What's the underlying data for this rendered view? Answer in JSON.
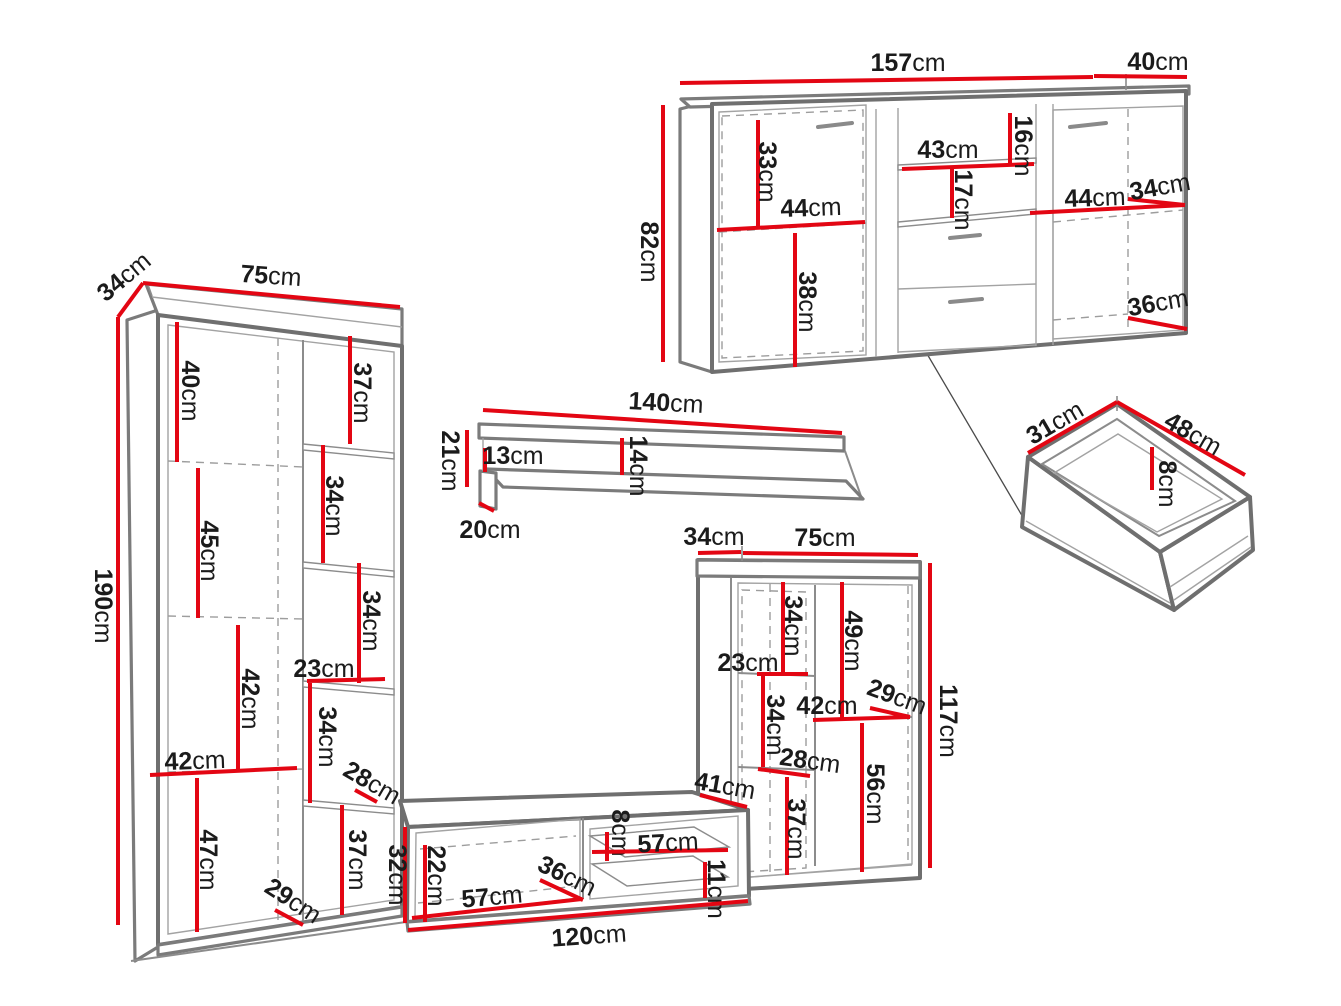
{
  "meta": {
    "title": "Wall unit furniture dimension diagram",
    "unit": "cm",
    "canvas": {
      "width": 1341,
      "height": 1006
    }
  },
  "colors": {
    "dimension_line": "#e30613",
    "outline": "#7b7b7b",
    "outline_light": "#a3a3a3",
    "label_text": "#1b1b1b",
    "background": "#ffffff"
  },
  "pieces": [
    {
      "id": "bookcase",
      "label": "tall bookcase",
      "width": "75cm",
      "depth": "34cm",
      "height": "190cm"
    },
    {
      "id": "sideboard",
      "label": "sideboard",
      "width": "157cm",
      "depth": "40cm",
      "height": "82cm"
    },
    {
      "id": "wall-shelf",
      "label": "wall shelf",
      "width": "140cm",
      "depth": "20cm",
      "height": "21cm"
    },
    {
      "id": "cabinet",
      "label": "display cabinet",
      "width": "75cm",
      "depth": "34cm",
      "height": "117cm"
    },
    {
      "id": "tv-stand",
      "label": "tv stand",
      "width": "120cm",
      "depth": "41cm",
      "height": "32cm"
    },
    {
      "id": "drawer",
      "label": "drawer box",
      "width": "48cm",
      "depth": "31cm",
      "height": "8cm"
    }
  ],
  "dimensions": [
    {
      "id": "bookcase-depth",
      "piece": "bookcase",
      "value": "34",
      "unit": "cm",
      "x": 124,
      "y": 277,
      "rot": -40,
      "line": [
        118,
        317,
        143,
        283
      ]
    },
    {
      "id": "bookcase-width",
      "piece": "bookcase",
      "value": "75",
      "unit": "cm",
      "x": 271,
      "y": 276,
      "rot": 4,
      "line": [
        143,
        283,
        400,
        307
      ]
    },
    {
      "id": "bookcase-height",
      "piece": "bookcase",
      "value": "190",
      "unit": "cm",
      "x": 103,
      "y": 606,
      "rot": 90,
      "line": [
        118,
        317,
        118,
        925
      ]
    },
    {
      "id": "bookcase-top-shelf-height",
      "piece": "bookcase",
      "value": "40",
      "unit": "cm",
      "x": 190,
      "y": 391,
      "rot": 90,
      "line": [
        177,
        322,
        177,
        462
      ]
    },
    {
      "id": "bookcase-shelf2-height",
      "piece": "bookcase",
      "value": "45",
      "unit": "cm",
      "x": 209,
      "y": 551,
      "rot": 90,
      "line": [
        198,
        468,
        198,
        618
      ]
    },
    {
      "id": "bookcase-shelf3-height",
      "piece": "bookcase",
      "value": "42",
      "unit": "cm",
      "x": 250,
      "y": 699,
      "rot": 90,
      "line": [
        238,
        625,
        238,
        772
      ]
    },
    {
      "id": "bookcase-inner-width",
      "piece": "bookcase",
      "value": "42",
      "unit": "cm",
      "x": 195,
      "y": 761,
      "rot": -2,
      "line": [
        150,
        775,
        297,
        768
      ]
    },
    {
      "id": "bookcase-bottom-height",
      "piece": "bookcase",
      "value": "47",
      "unit": "cm",
      "x": 208,
      "y": 860,
      "rot": 90,
      "line": [
        197,
        778,
        197,
        932
      ]
    },
    {
      "id": "bookcase-side-shelf1",
      "piece": "bookcase",
      "value": "37",
      "unit": "cm",
      "x": 362,
      "y": 393,
      "rot": 90,
      "line": [
        350,
        336,
        350,
        444
      ]
    },
    {
      "id": "bookcase-side-shelf2",
      "piece": "bookcase",
      "value": "34",
      "unit": "cm",
      "x": 334,
      "y": 506,
      "rot": 90,
      "line": [
        323,
        445,
        323,
        563
      ]
    },
    {
      "id": "bookcase-side-shelf3",
      "piece": "bookcase",
      "value": "34",
      "unit": "cm",
      "x": 371,
      "y": 621,
      "rot": 90,
      "line": [
        359,
        563,
        359,
        683
      ]
    },
    {
      "id": "bookcase-side-width",
      "piece": "bookcase",
      "value": "23",
      "unit": "cm",
      "x": 324,
      "y": 669,
      "rot": 0,
      "line": [
        307,
        681,
        385,
        679
      ]
    },
    {
      "id": "bookcase-side-shelf4",
      "piece": "bookcase",
      "value": "34",
      "unit": "cm",
      "x": 327,
      "y": 737,
      "rot": 90,
      "line": [
        310,
        683,
        310,
        803
      ]
    },
    {
      "id": "bookcase-side-depth1",
      "piece": "bookcase",
      "value": "28",
      "unit": "cm",
      "x": 372,
      "y": 783,
      "rot": 30,
      "line": [
        355,
        790,
        377,
        802
      ]
    },
    {
      "id": "bookcase-side-shelf5",
      "piece": "bookcase",
      "value": "37",
      "unit": "cm",
      "x": 357,
      "y": 860,
      "rot": 90,
      "line": [
        342,
        805,
        342,
        915
      ]
    },
    {
      "id": "bookcase-side-depth2",
      "piece": "bookcase",
      "value": "29",
      "unit": "cm",
      "x": 293,
      "y": 901,
      "rot": 33,
      "line": [
        275,
        910,
        303,
        925
      ]
    },
    {
      "id": "sideboard-width",
      "piece": "sideboard",
      "value": "157",
      "unit": "cm",
      "x": 908,
      "y": 63,
      "rot": 0,
      "line": [
        680,
        83,
        1093,
        77
      ]
    },
    {
      "id": "sideboard-depth",
      "piece": "sideboard",
      "value": "40",
      "unit": "cm",
      "x": 1158,
      "y": 62,
      "rot": 0,
      "line": [
        1094,
        76,
        1187,
        77
      ]
    },
    {
      "id": "sideboard-height",
      "piece": "sideboard",
      "value": "82",
      "unit": "cm",
      "x": 649,
      "y": 252,
      "rot": 90,
      "line": [
        663,
        105,
        663,
        362
      ]
    },
    {
      "id": "sideboard-left-shelf-height",
      "piece": "sideboard",
      "value": "33",
      "unit": "cm",
      "x": 767,
      "y": 172,
      "rot": 90,
      "line": [
        758,
        120,
        758,
        228
      ]
    },
    {
      "id": "sideboard-middle-width",
      "piece": "sideboard",
      "value": "43",
      "unit": "cm",
      "x": 948,
      "y": 150,
      "rot": 0,
      "line": [
        902,
        169,
        1034,
        164
      ]
    },
    {
      "id": "sideboard-middle-top-height",
      "piece": "sideboard",
      "value": "16",
      "unit": "cm",
      "x": 1023,
      "y": 146,
      "rot": 90,
      "line": [
        1010,
        113,
        1010,
        165
      ]
    },
    {
      "id": "sideboard-middle-shelf-height",
      "piece": "sideboard",
      "value": "17",
      "unit": "cm",
      "x": 963,
      "y": 200,
      "rot": 90,
      "line": [
        952,
        169,
        952,
        218
      ]
    },
    {
      "id": "sideboard-left-width",
      "piece": "sideboard",
      "value": "44",
      "unit": "cm",
      "x": 811,
      "y": 208,
      "rot": -2,
      "line": [
        717,
        230,
        865,
        222
      ]
    },
    {
      "id": "sideboard-left-lower-height",
      "piece": "sideboard",
      "value": "38",
      "unit": "cm",
      "x": 807,
      "y": 302,
      "rot": 90,
      "line": [
        795,
        233,
        795,
        367
      ]
    },
    {
      "id": "sideboard-right-width",
      "piece": "sideboard",
      "value": "44",
      "unit": "cm",
      "x": 1095,
      "y": 198,
      "rot": -2,
      "line": [
        1030,
        213,
        1185,
        205
      ]
    },
    {
      "id": "sideboard-right-depth",
      "piece": "sideboard",
      "value": "34",
      "unit": "cm",
      "x": 1160,
      "y": 187,
      "rot": -10,
      "line": [
        1128,
        199,
        1185,
        205
      ]
    },
    {
      "id": "sideboard-right-lower-depth",
      "piece": "sideboard",
      "value": "36",
      "unit": "cm",
      "x": 1158,
      "y": 303,
      "rot": -10,
      "line": [
        1128,
        318,
        1187,
        329
      ]
    },
    {
      "id": "shelf-width",
      "piece": "wall-shelf",
      "value": "140",
      "unit": "cm",
      "x": 666,
      "y": 403,
      "rot": 3,
      "line": [
        483,
        410,
        842,
        433
      ]
    },
    {
      "id": "shelf-height",
      "piece": "wall-shelf",
      "value": "21",
      "unit": "cm",
      "x": 450,
      "y": 461,
      "rot": 90,
      "line": [
        467,
        430,
        467,
        487
      ]
    },
    {
      "id": "shelf-back-height",
      "piece": "wall-shelf",
      "value": "13",
      "unit": "cm",
      "x": 513,
      "y": 456,
      "rot": 0,
      "line": [
        485,
        448,
        485,
        472
      ]
    },
    {
      "id": "shelf-front-height",
      "piece": "wall-shelf",
      "value": "14",
      "unit": "cm",
      "x": 638,
      "y": 466,
      "rot": 90,
      "line": [
        622,
        438,
        622,
        475
      ]
    },
    {
      "id": "shelf-depth",
      "piece": "wall-shelf",
      "value": "20",
      "unit": "cm",
      "x": 490,
      "y": 530,
      "rot": 0,
      "line": [
        479,
        503,
        494,
        511
      ]
    },
    {
      "id": "cabinet-depth",
      "piece": "cabinet",
      "value": "34",
      "unit": "cm",
      "x": 714,
      "y": 537,
      "rot": 0,
      "line": [
        698,
        553,
        741,
        552
      ]
    },
    {
      "id": "cabinet-width",
      "piece": "cabinet",
      "value": "75",
      "unit": "cm",
      "x": 825,
      "y": 538,
      "rot": 0,
      "line": [
        743,
        553,
        918,
        555
      ]
    },
    {
      "id": "cabinet-height",
      "piece": "cabinet",
      "value": "117",
      "unit": "cm",
      "x": 948,
      "y": 721,
      "rot": 90,
      "line": [
        930,
        563,
        930,
        868
      ]
    },
    {
      "id": "cabinet-left-shelf1",
      "piece": "cabinet",
      "value": "34",
      "unit": "cm",
      "x": 793,
      "y": 626,
      "rot": 90,
      "line": [
        783,
        582,
        783,
        673
      ]
    },
    {
      "id": "cabinet-right-shelf1",
      "piece": "cabinet",
      "value": "49",
      "unit": "cm",
      "x": 853,
      "y": 641,
      "rot": 90,
      "line": [
        842,
        582,
        842,
        720
      ]
    },
    {
      "id": "cabinet-left-width",
      "piece": "cabinet",
      "value": "23",
      "unit": "cm",
      "x": 748,
      "y": 663,
      "rot": 0,
      "line": [
        757,
        674,
        808,
        674
      ]
    },
    {
      "id": "cabinet-right-width",
      "piece": "cabinet",
      "value": "42",
      "unit": "cm",
      "x": 827,
      "y": 706,
      "rot": 0,
      "line": [
        813,
        720,
        910,
        717
      ]
    },
    {
      "id": "cabinet-right-depth",
      "piece": "cabinet",
      "value": "29",
      "unit": "cm",
      "x": 897,
      "y": 697,
      "rot": 20,
      "line": [
        870,
        708,
        910,
        717
      ]
    },
    {
      "id": "cabinet-left-shelf2",
      "piece": "cabinet",
      "value": "34",
      "unit": "cm",
      "x": 775,
      "y": 725,
      "rot": 90,
      "line": [
        763,
        675,
        763,
        767
      ]
    },
    {
      "id": "cabinet-left-depth",
      "piece": "cabinet",
      "value": "28",
      "unit": "cm",
      "x": 810,
      "y": 761,
      "rot": 8,
      "line": [
        758,
        769,
        810,
        776
      ]
    },
    {
      "id": "cabinet-left-shelf3",
      "piece": "cabinet",
      "value": "37",
      "unit": "cm",
      "x": 796,
      "y": 829,
      "rot": 90,
      "line": [
        787,
        777,
        787,
        875
      ]
    },
    {
      "id": "cabinet-right-shelf2",
      "piece": "cabinet",
      "value": "56",
      "unit": "cm",
      "x": 875,
      "y": 794,
      "rot": 90,
      "line": [
        862,
        723,
        862,
        872
      ]
    },
    {
      "id": "tvstand-top-depth",
      "piece": "tv-stand",
      "value": "41",
      "unit": "cm",
      "x": 725,
      "y": 786,
      "rot": 10,
      "line": [
        700,
        795,
        747,
        807
      ]
    },
    {
      "id": "tvstand-height",
      "piece": "tv-stand",
      "value": "32",
      "unit": "cm",
      "x": 397,
      "y": 875,
      "rot": 90,
      "line": [
        405,
        827,
        405,
        923
      ]
    },
    {
      "id": "tvstand-inner-height",
      "piece": "tv-stand",
      "value": "22",
      "unit": "cm",
      "x": 436,
      "y": 876,
      "rot": 90,
      "line": [
        425,
        845,
        425,
        922
      ]
    },
    {
      "id": "tvstand-left-width",
      "piece": "tv-stand",
      "value": "57",
      "unit": "cm",
      "x": 492,
      "y": 897,
      "rot": -5,
      "line": [
        412,
        918,
        582,
        899
      ]
    },
    {
      "id": "tvstand-inner-depth",
      "piece": "tv-stand",
      "value": "36",
      "unit": "cm",
      "x": 567,
      "y": 876,
      "rot": 26,
      "line": [
        540,
        880,
        583,
        900
      ]
    },
    {
      "id": "tvstand-shelf-gap",
      "piece": "tv-stand",
      "value": "8",
      "unit": "cm",
      "x": 620,
      "y": 833,
      "rot": 90,
      "line": [
        607,
        832,
        607,
        861
      ]
    },
    {
      "id": "tvstand-shelf-width",
      "piece": "tv-stand",
      "value": "57",
      "unit": "cm",
      "x": 668,
      "y": 843,
      "rot": -3,
      "line": [
        592,
        852,
        728,
        850
      ]
    },
    {
      "id": "tvstand-lower-gap",
      "piece": "tv-stand",
      "value": "11",
      "unit": "cm",
      "x": 716,
      "y": 889,
      "rot": 90,
      "line": [
        705,
        862,
        705,
        898
      ]
    },
    {
      "id": "tvstand-width",
      "piece": "tv-stand",
      "value": "120",
      "unit": "cm",
      "x": 589,
      "y": 936,
      "rot": -4,
      "line": [
        408,
        930,
        748,
        901
      ]
    },
    {
      "id": "drawer-depth",
      "piece": "drawer",
      "value": "31",
      "unit": "cm",
      "x": 1055,
      "y": 423,
      "rot": -30,
      "line": [
        1028,
        453,
        1117,
        402
      ]
    },
    {
      "id": "drawer-width",
      "piece": "drawer",
      "value": "48",
      "unit": "cm",
      "x": 1193,
      "y": 434,
      "rot": 30,
      "line": [
        1117,
        402,
        1245,
        475
      ]
    },
    {
      "id": "drawer-height",
      "piece": "drawer",
      "value": "8",
      "unit": "cm",
      "x": 1167,
      "y": 484,
      "rot": 90,
      "line": [
        1152,
        447,
        1152,
        490
      ]
    }
  ]
}
